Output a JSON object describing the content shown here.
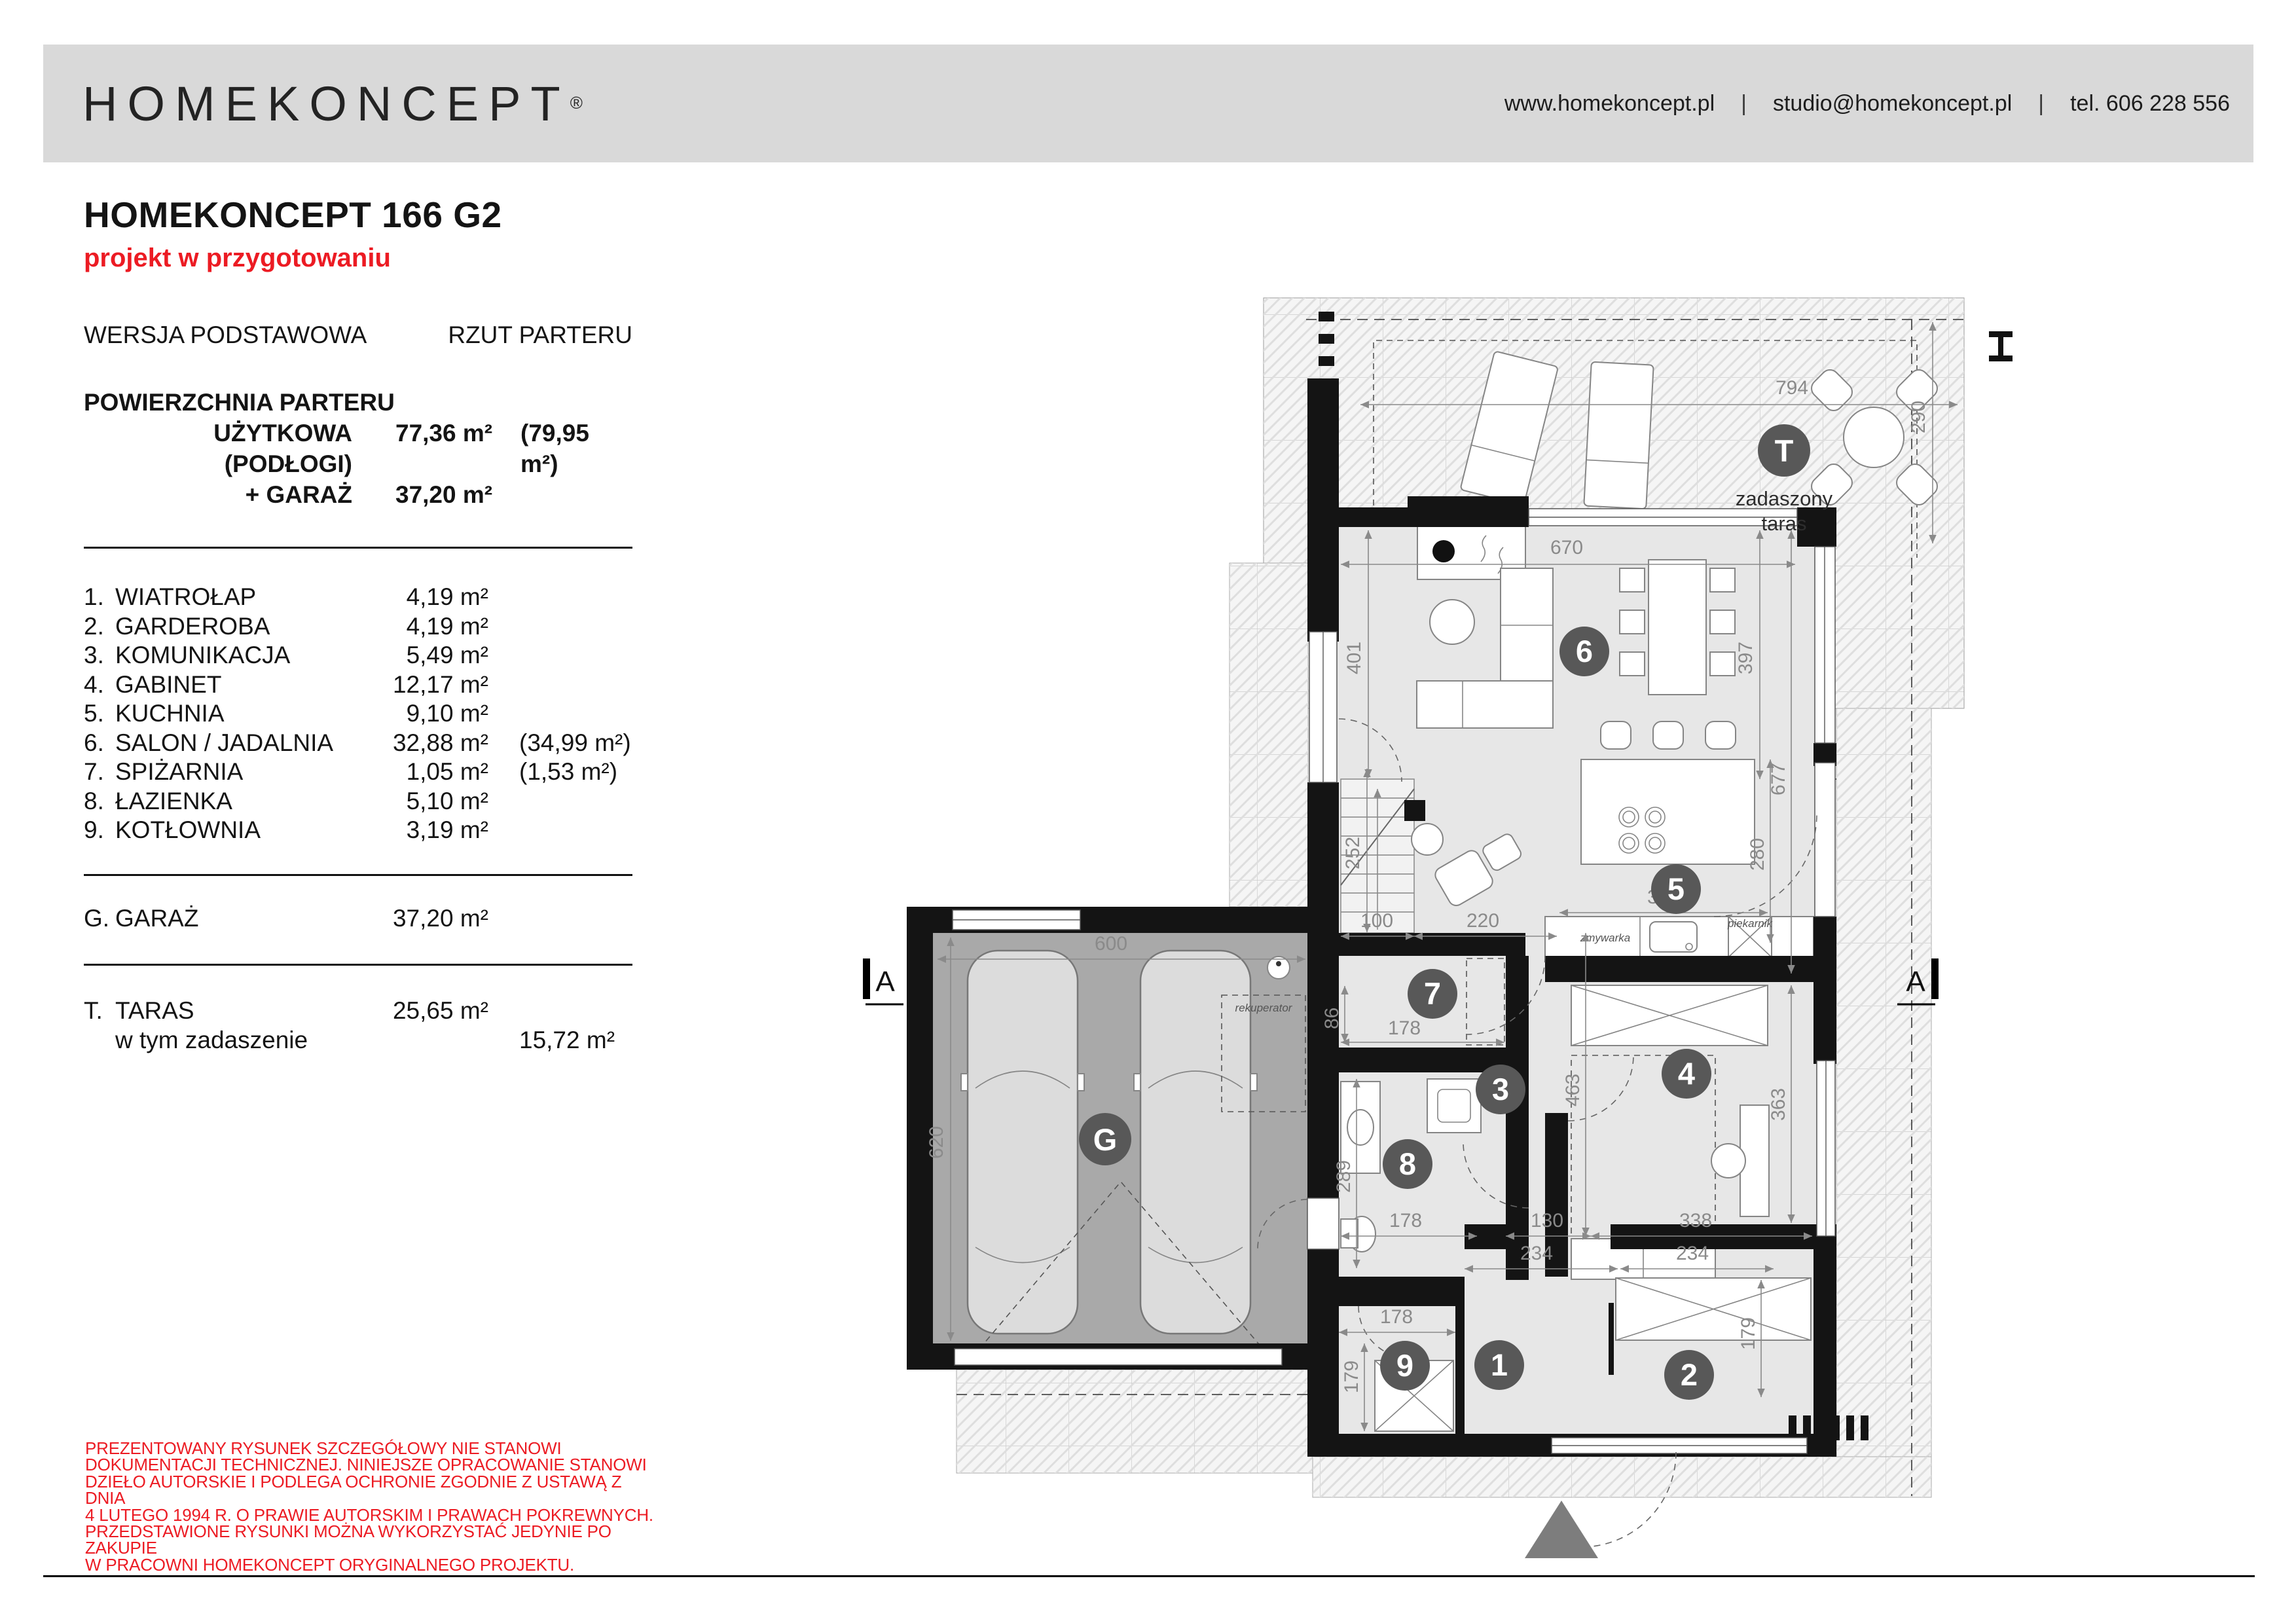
{
  "logo": {
    "text": "HOMEKONCEPT",
    "mark": "®"
  },
  "header": {
    "website": "www.homekoncept.pl",
    "sep1": "|",
    "email": "studio@homekoncept.pl",
    "sep2": "|",
    "phone": "tel. 606 228 556"
  },
  "title": {
    "name": "HOMEKONCEPT 166 G2",
    "status": "projekt w przygotowaniu",
    "version": "WERSJA PODSTAWOWA",
    "view": "RZUT PARTERU"
  },
  "area": {
    "heading": "POWIERZCHNIA PARTERU",
    "rows": [
      {
        "label": "UŻYTKOWA (PODŁOGI)",
        "value": "77,36 m²",
        "extra": "(79,95 m²)"
      },
      {
        "label": "+ GARAŻ",
        "value": "37,20 m²",
        "extra": ""
      }
    ]
  },
  "rooms": [
    {
      "no": "1.",
      "name": "WIATROŁAP",
      "area": "4,19 m²",
      "extra": ""
    },
    {
      "no": "2.",
      "name": "GARDEROBA",
      "area": "4,19 m²",
      "extra": ""
    },
    {
      "no": "3.",
      "name": "KOMUNIKACJA",
      "area": "5,49 m²",
      "extra": ""
    },
    {
      "no": "4.",
      "name": "GABINET",
      "area": "12,17 m²",
      "extra": ""
    },
    {
      "no": "5.",
      "name": "KUCHNIA",
      "area": "9,10 m²",
      "extra": ""
    },
    {
      "no": "6.",
      "name": "SALON / JADALNIA",
      "area": "32,88 m²",
      "extra": "(34,99 m²)"
    },
    {
      "no": "7.",
      "name": "SPIŻARNIA",
      "area": "1,05 m²",
      "extra": "(1,53 m²)"
    },
    {
      "no": "8.",
      "name": "ŁAZIENKA",
      "area": "5,10 m²",
      "extra": ""
    },
    {
      "no": "9.",
      "name": "KOTŁOWNIA",
      "area": "3,19 m²",
      "extra": ""
    }
  ],
  "garage": {
    "no": "G.",
    "name": "GARAŻ",
    "area": "37,20 m²"
  },
  "terrace": {
    "no": "T.",
    "name": "TARAS",
    "area": "25,65 m²",
    "sub_label": "w tym zadaszenie",
    "sub_area": "15,72 m²"
  },
  "disclaimer": [
    "PREZENTOWANY RYSUNEK SZCZEGÓŁOWY NIE STANOWI",
    "DOKUMENTACJI TECHNICZNEJ. NINIEJSZE OPRACOWANIE STANOWI",
    "DZIEŁO AUTORSKIE I PODLEGA OCHRONIE ZGODNIE Z USTAWĄ Z DNIA",
    "4 LUTEGO 1994 R. O PRAWIE AUTORSKIM I PRAWACH POKREWNYCH.",
    "PRZEDSTAWIONE RYSUNKI MOŻNA WYKORZYSTAĆ JEDYNIE PO ZAKUPIE",
    "W PRACOWNI HOMEKONCEPT ORYGINALNEGO PROJEKTU."
  ],
  "plan": {
    "labels": {
      "terrace1": "zadaszony",
      "terrace2": "taras",
      "dishwasher": "zmywarka",
      "oven": "piekarnik",
      "recuperator": "rekuperator",
      "sectionL": "A",
      "sectionR": "A"
    },
    "badges": {
      "b1": "1",
      "b2": "2",
      "b3": "3",
      "b4": "4",
      "b5": "5",
      "b6": "6",
      "b7": "7",
      "b8": "8",
      "b9": "9",
      "bG": "G",
      "bT": "T"
    },
    "dims": {
      "d794": "794",
      "d290": "290",
      "d670": "670",
      "d401": "401",
      "d397": "397",
      "d677": "677",
      "d280": "280",
      "d325": "325",
      "d252": "252",
      "d100": "100",
      "d220": "220",
      "d86": "86",
      "d178_7": "178",
      "d463": "463",
      "d289": "289",
      "d178_8": "178",
      "d130": "130",
      "d338": "338",
      "d363": "363",
      "d178_9": "178",
      "d179_9": "179",
      "d234_1": "234",
      "d234_2": "234",
      "d179_2": "179",
      "d600": "600",
      "d620": "620"
    }
  }
}
